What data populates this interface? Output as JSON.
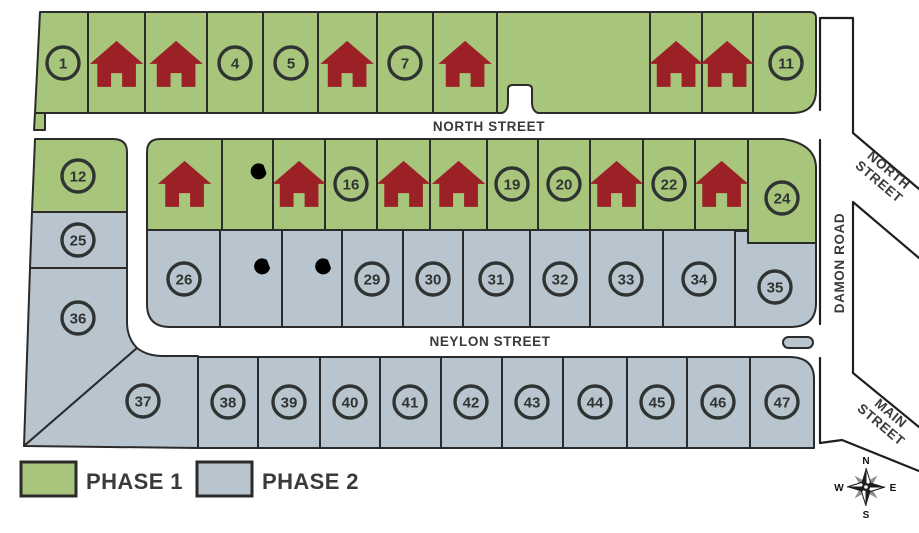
{
  "map_type": "subdivision-phase-plan",
  "legend": {
    "items": [
      {
        "label": "PHASE 1",
        "color": "#a7c67c"
      },
      {
        "label": "PHASE 2",
        "color": "#b9c5ce"
      }
    ]
  },
  "streets": {
    "north": "NORTH STREET",
    "neylon": "NEYLON STREET",
    "damon": "DAMON ROAD",
    "north_branch": {
      "line1": "NORTH",
      "line2": "STREET"
    },
    "main_branch": {
      "line1": "MAIN",
      "line2": "STREET"
    }
  },
  "compass": {
    "north": "N",
    "south": "S",
    "east": "E",
    "west": "W"
  },
  "colors": {
    "phase1_green": "#a7c67c",
    "phase2_gray": "#b9c5ce",
    "house_red": "#9c2127",
    "outline": "#2b2b2b"
  },
  "lots": {
    "row_top": [
      {
        "type": "number",
        "label": "1"
      },
      {
        "type": "house"
      },
      {
        "type": "house"
      },
      {
        "type": "number",
        "label": "4"
      },
      {
        "type": "number",
        "label": "5"
      },
      {
        "type": "house"
      },
      {
        "type": "number",
        "label": "7"
      },
      {
        "type": "house"
      },
      {
        "type": "parcel",
        "label": ""
      },
      {
        "type": "house"
      },
      {
        "type": "house"
      },
      {
        "type": "number",
        "label": "11"
      }
    ],
    "west": [
      {
        "type": "number",
        "label": "12"
      },
      {
        "type": "number",
        "label": "25"
      },
      {
        "type": "number",
        "label": "36"
      }
    ],
    "row2": [
      {
        "type": "house"
      },
      {
        "type": "tools"
      },
      {
        "type": "house"
      },
      {
        "type": "number",
        "label": "16"
      },
      {
        "type": "house"
      },
      {
        "type": "house"
      },
      {
        "type": "number",
        "label": "19"
      },
      {
        "type": "number",
        "label": "20"
      },
      {
        "type": "house"
      },
      {
        "type": "number",
        "label": "22"
      },
      {
        "type": "house"
      },
      {
        "type": "number",
        "label": "24"
      }
    ],
    "row3": [
      {
        "type": "number",
        "label": "26"
      },
      {
        "type": "tools"
      },
      {
        "type": "tools"
      },
      {
        "type": "number",
        "label": "29"
      },
      {
        "type": "number",
        "label": "30"
      },
      {
        "type": "number",
        "label": "31"
      },
      {
        "type": "number",
        "label": "32"
      },
      {
        "type": "number",
        "label": "33"
      },
      {
        "type": "number",
        "label": "34"
      },
      {
        "type": "number",
        "label": "35"
      }
    ],
    "row4": [
      {
        "type": "number",
        "label": "37"
      },
      {
        "type": "number",
        "label": "38"
      },
      {
        "type": "number",
        "label": "39"
      },
      {
        "type": "number",
        "label": "40"
      },
      {
        "type": "number",
        "label": "41"
      },
      {
        "type": "number",
        "label": "42"
      },
      {
        "type": "number",
        "label": "43"
      },
      {
        "type": "number",
        "label": "44"
      },
      {
        "type": "number",
        "label": "45"
      },
      {
        "type": "number",
        "label": "46"
      },
      {
        "type": "number",
        "label": "47"
      }
    ]
  }
}
